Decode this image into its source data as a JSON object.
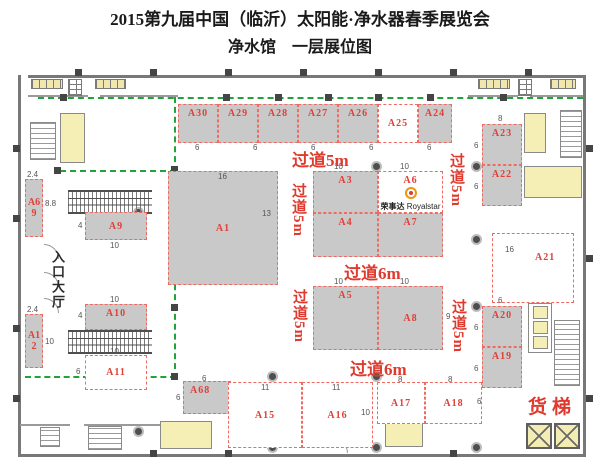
{
  "header": {
    "title": "2015第九届中国（临沂）太阳能·净水器春季展览会",
    "subtitle": "净水馆　一层展位图"
  },
  "booths": {
    "a30": {
      "label": "A30"
    },
    "a29": {
      "label": "A29"
    },
    "a28": {
      "label": "A28"
    },
    "a27": {
      "label": "A27"
    },
    "a26": {
      "label": "A26"
    },
    "a25": {
      "label": "A25"
    },
    "a24": {
      "label": "A24"
    },
    "a1": {
      "label": "A1",
      "w": "16",
      "h": "13"
    },
    "a3": {
      "label": "A3",
      "w": "10"
    },
    "a6": {
      "label": "A6",
      "w": "10"
    },
    "a4": {
      "label": "A4"
    },
    "a7": {
      "label": "A7"
    },
    "a5": {
      "label": "A5",
      "w": "10"
    },
    "a8": {
      "label": "A8",
      "w": "10",
      "h": "9"
    },
    "a23": {
      "label": "A23",
      "w": "8",
      "h": "6"
    },
    "a22": {
      "label": "A22",
      "h": "6"
    },
    "a21": {
      "label": "A21",
      "w": "16"
    },
    "a20": {
      "label": "A20",
      "w": "6",
      "h": "6"
    },
    "a19": {
      "label": "A19",
      "h": "6"
    },
    "a69": {
      "label": "A69",
      "w": "2.4",
      "h": "8.8"
    },
    "a9": {
      "label": "A9",
      "h": "4",
      "w": "10"
    },
    "a10": {
      "label": "A10",
      "w": "10",
      "h": "4"
    },
    "a11": {
      "label": "A11",
      "w": "10",
      "h": "6"
    },
    "a12": {
      "label": "A12",
      "w": "2.4",
      "h": "10"
    },
    "a68": {
      "label": "A68",
      "w": "6",
      "h": "6"
    },
    "a15": {
      "label": "A15",
      "w": "11"
    },
    "a16": {
      "label": "A16",
      "w": "11",
      "h": "10"
    },
    "a17": {
      "label": "A17",
      "w": "8"
    },
    "a18": {
      "label": "A18",
      "w": "8",
      "h": "6"
    }
  },
  "aisles": {
    "top": "过道5m",
    "left_center": "过道5m",
    "right_center": "过道5m",
    "left_lower": "过道5m",
    "right_lower": "过道5m",
    "center_upper": "过道6m",
    "center_lower": "过道6m"
  },
  "top_row_dims": [
    "6",
    "6",
    "6",
    "6",
    "6"
  ],
  "labels": {
    "entrance": "入口大厅",
    "freight_elevator": "货梯"
  },
  "logo": {
    "zh": "荣事达",
    "en": "Royalstar",
    "booth": "A6"
  },
  "colors": {
    "booth_fill": "#c9c9c9",
    "booth_label": "#df4038",
    "aisle_text": "#df3a2e",
    "dashed_border": "#ef6a60",
    "route_green": "#21a33c",
    "room_yellow": "#f5efb5",
    "wall": "#787878"
  }
}
